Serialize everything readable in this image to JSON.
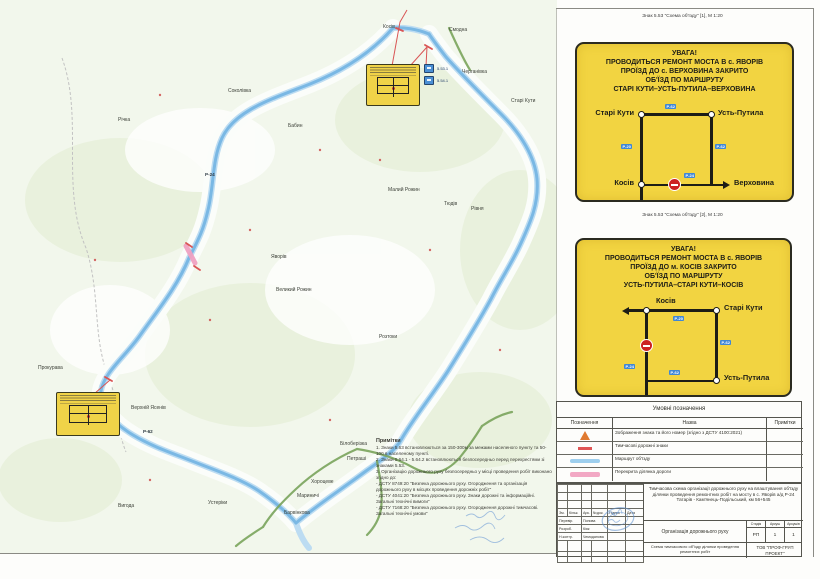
{
  "captions": [
    "Знак 5.53 \"Схема об'їзду\" [1], М 1:20",
    "Знак 5.53 \"Схема об'їзду\" [2], М 1:20"
  ],
  "signs": [
    {
      "header": "УВАГА!\nПРОВОДИТЬСЯ РЕМОНТ МОСТА В с. ЯВОРІВ\nПРОЇЗД ДО с. ВЕРХОВИНА ЗАКРИТО\nОБ'ЇЗД ПО МАРШРУТУ\nСТАРІ КУТИ–УСТЬ-ПУТИЛА–ВЕРХОВИНА",
      "nodes": {
        "top_left": "Старі Кути",
        "top_right": "Усть-Путила",
        "bottom_left": "Косів",
        "arrow": "Верховина"
      },
      "badges": {
        "top": "Р-62",
        "left": "Р-20",
        "right": "Р-62",
        "bottom": "Р-24"
      }
    },
    {
      "header": "УВАГА!\nПРОВОДИТЬСЯ РЕМОНТ МОСТА В с. ЯВОРІВ\nПРОЇЗД ДО м. КОСІВ ЗАКРИТО\nОБ'ЇЗД ПО МАРШРУТУ\nУСТЬ-ПУТИЛА–СТАРІ КУТИ–КОСІВ",
      "nodes": {
        "top_left": "Косів",
        "top_right": "Старі Кути",
        "bottom_right": "Усть-Путила"
      },
      "badges": {
        "top": "Р-20",
        "left": "Р-24",
        "right": "Р-62",
        "bottom": "Р-62"
      }
    }
  ],
  "legend": {
    "title": "Умовні позначення",
    "columns": [
      "Позначення",
      "Назва",
      "Примітки"
    ],
    "rows": [
      {
        "icon": "warning-sign-symbol",
        "name": "Зображення знака та його номер (згідно з ДСТУ 4100:2021)"
      },
      {
        "icon": "temporary-sign-mark",
        "name": "Тимчасові дорожні знаки"
      },
      {
        "icon": "detour-route-line",
        "name": "Маршрут об'їзду"
      },
      {
        "icon": "closed-road-line",
        "name": "Перекрита ділянка дороги"
      }
    ]
  },
  "notes": {
    "title": "Примітки",
    "lines": [
      "1. Знаки 5.63 встановлюються за 150-300м за межами населеного пункту та 50-100 в населеному пункті.",
      "2. Знаки 5.64.1 - 5.64.2 встановлюються безпосередньо перед перехрестями зі знаками 5.53.",
      "3. Організацію дорожнього руху безпосередньо у місці проведення робіт виконано згідно до:",
      "- ДСТУ 8749:20 \"Безпека дорожнього руху. Огородження та організація дорожнього руху в місцях проведення дорожніх робіт\"",
      "- ДСТУ 4041:20 \"Безпека дорожнього руху. Знаки дорожні та інформаційні. Загальні технічні вимоги\"",
      "- ДСТУ 7168:20 \"Безпека дорожнього руху. Огородження дорожні тимчасові. Загальні технічні умови\""
    ]
  },
  "title_block": {
    "project": "Тимчасова схема організації дорожнього руху на влаштування об'їзду ділянки проведення ремонтних робіт на мосту в с. Яворів а/д Р-24 Татарів - Кам'янець-Подільський, км 56+545",
    "section_title": "Організація дорожнього руху",
    "stage_label": "Стадія",
    "sheet_label": "Аркуш",
    "sheets_label": "Аркушів",
    "stage": "РП",
    "sheet": "1",
    "sheets": "1",
    "scheme_title": "Схема тимчасового об'їзду ділянки проведення ремонтних робіт",
    "company": "ТОВ \"ПРОФ-ГРУП ПРОЕКТ\"",
    "revision_columns": [
      "Зм.",
      "Кільк.",
      "Арк.",
      "№док.",
      "Підпис",
      "Дата"
    ],
    "people": [
      {
        "role": "Перевір.",
        "name": "Попова"
      },
      {
        "role": "Розроб.",
        "name": "Кіяк"
      },
      {
        "role": "Н.контр.",
        "name": "Чемоданова"
      }
    ]
  },
  "map": {
    "labels": [
      {
        "text": "Косів",
        "x": 383,
        "y": 24
      },
      {
        "text": "Смодна",
        "x": 449,
        "y": 27
      },
      {
        "text": "Черганівка",
        "x": 462,
        "y": 69
      },
      {
        "text": "Старі Кути",
        "x": 511,
        "y": 98
      },
      {
        "text": "Соколівка",
        "x": 228,
        "y": 88
      },
      {
        "text": "Річка",
        "x": 118,
        "y": 117
      },
      {
        "text": "Бабин",
        "x": 288,
        "y": 123
      },
      {
        "text": "Малий Рожин",
        "x": 388,
        "y": 187
      },
      {
        "text": "Тюдів",
        "x": 444,
        "y": 201
      },
      {
        "text": "Рівня",
        "x": 471,
        "y": 206
      },
      {
        "text": "Яворів",
        "x": 271,
        "y": 254
      },
      {
        "text": "Великий Рожин",
        "x": 276,
        "y": 287
      },
      {
        "text": "Розтоки",
        "x": 379,
        "y": 334
      },
      {
        "text": "Прокурава",
        "x": 38,
        "y": 365
      },
      {
        "text": "Верхній Ясенів",
        "x": 131,
        "y": 405
      },
      {
        "text": "Вигода",
        "x": 118,
        "y": 503
      },
      {
        "text": "Устеріки",
        "x": 208,
        "y": 500
      },
      {
        "text": "Білоберізка",
        "x": 340,
        "y": 441
      },
      {
        "text": "Петраші",
        "x": 347,
        "y": 456
      },
      {
        "text": "Хороцеве",
        "x": 311,
        "y": 479
      },
      {
        "text": "Мариничі",
        "x": 297,
        "y": 493
      },
      {
        "text": "Барвінкова",
        "x": 284,
        "y": 510
      }
    ],
    "road_labels": [
      {
        "text": "Р-24",
        "x": 205,
        "y": 172
      },
      {
        "text": "Р-62",
        "x": 143,
        "y": 429
      }
    ],
    "sign_markers": [
      {
        "text": "5.53(1)",
        "x": 401,
        "y": 68
      },
      {
        "text": "5.53.1",
        "x": 437,
        "y": 66
      },
      {
        "text": "5.54.1",
        "x": 437,
        "y": 78
      }
    ]
  },
  "colors": {
    "sign_yellow": "#f2d441",
    "route_blue": "#7ab8e4",
    "closed_pink": "#f0a2c2",
    "road_green": "#7aa45c",
    "badge_blue": "#3f87d6",
    "no_entry_red": "#cc2222",
    "stamp_blue": "#5b8fd0"
  }
}
